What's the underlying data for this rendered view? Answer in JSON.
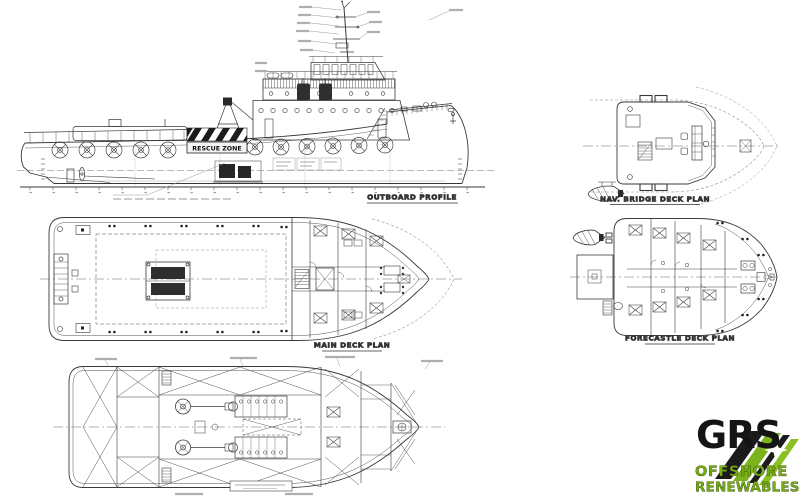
{
  "document": {
    "type": "ship-general-arrangement-drawing",
    "background": "#ffffff"
  },
  "views": {
    "outboard_profile": {
      "caption": "OUTBOARD PROFILE",
      "rescue_zone_label": "RESCUE ZONE"
    },
    "main_deck": {
      "caption": "MAIN DECK PLAN"
    },
    "nav_bridge": {
      "caption": "NAV. BRIDGE DECK PLAN"
    },
    "forecastle": {
      "caption": "FORECASTLE DECK PLAN"
    }
  },
  "logo": {
    "name": "GRS",
    "line1": "OFFSHORE",
    "line2": "RENEWABLES",
    "green": "#7cb21c",
    "dark": "#161616"
  }
}
